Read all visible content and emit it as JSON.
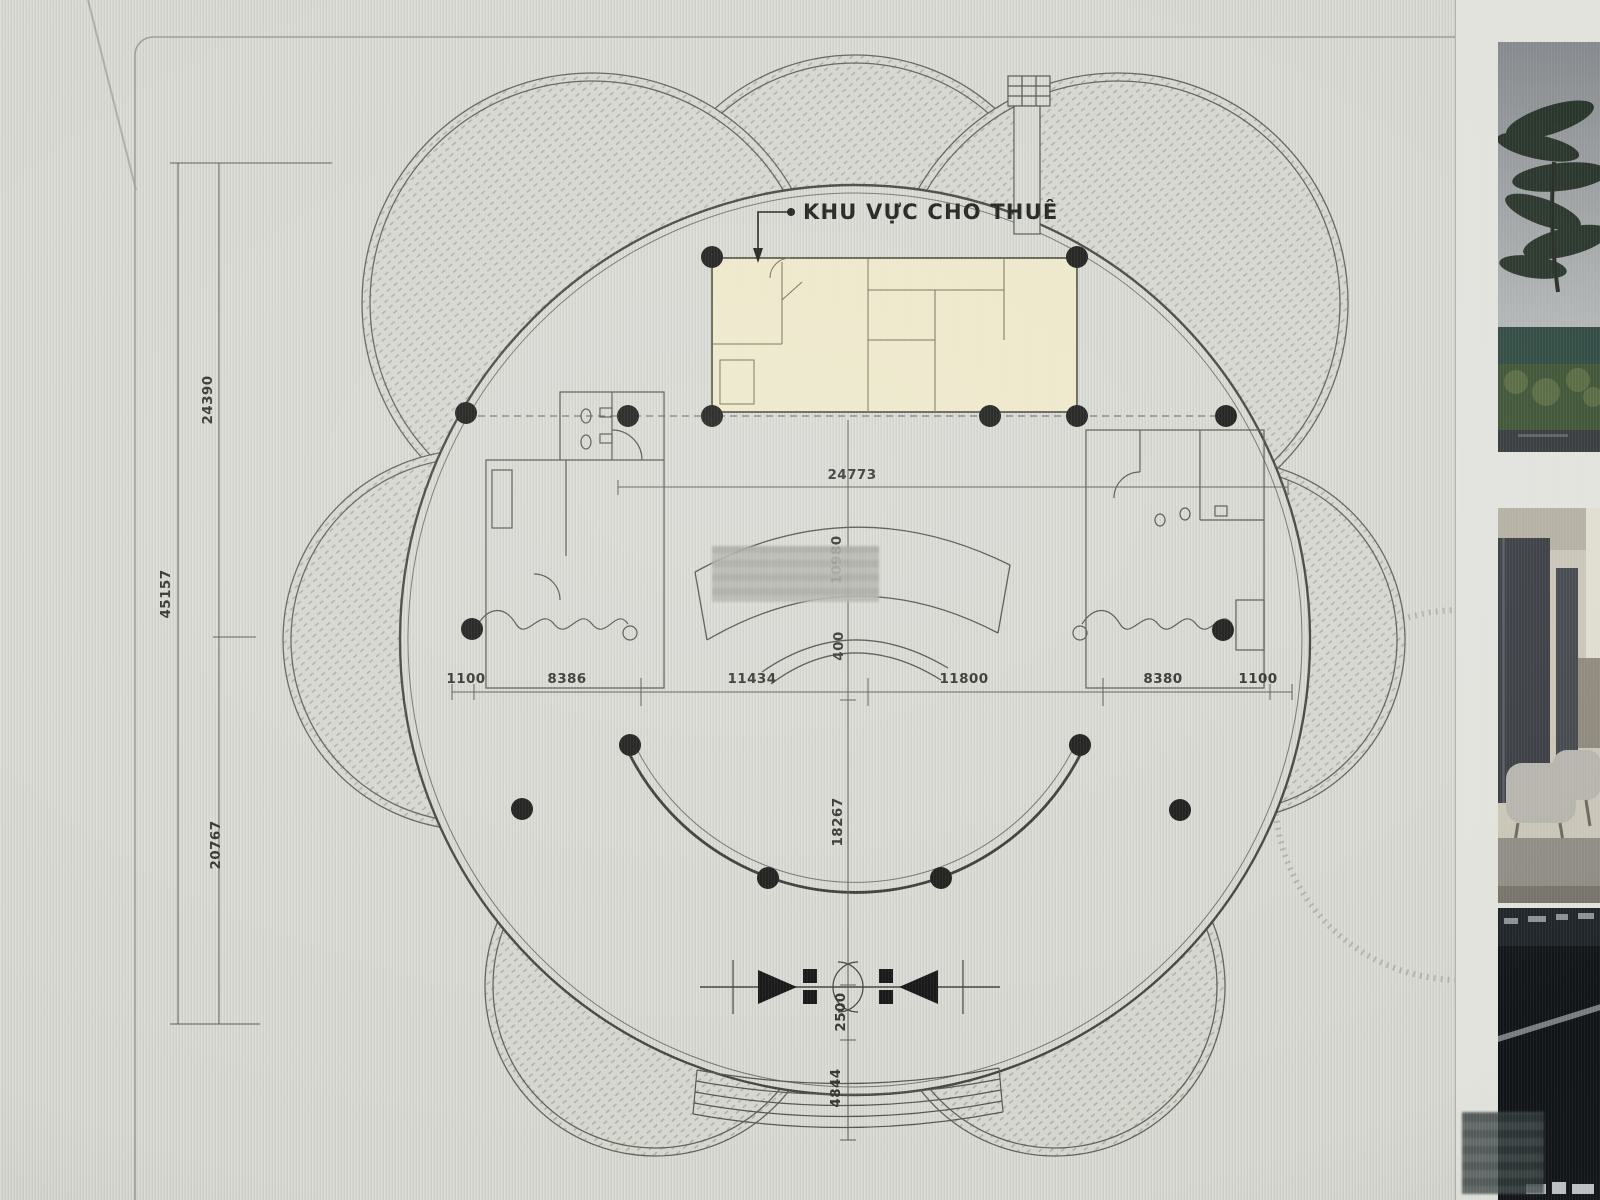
{
  "plan": {
    "leased_area_label": "KHU VỰC CHO THUÊ",
    "dims": {
      "total_height": "45157",
      "upper_height": "24390",
      "lower_height": "20767",
      "hall_width": "24773",
      "stage_depth": "10980",
      "stage_gap": "400",
      "hall_depth": "18267",
      "entrance_depth": "2500",
      "steps_depth": "4844",
      "bay_left_end": "1100",
      "bay_left": "8386",
      "bay_center_left": "11434",
      "bay_center_right": "11800",
      "bay_right": "8380",
      "bay_right_end": "1100"
    }
  },
  "gallery": {
    "photos": [
      "palm-trees-exterior",
      "lobby-interior",
      "building-dark-night"
    ]
  },
  "colors": {
    "leased_fill": "#ECE7C8",
    "plan_line": "#4C4F48",
    "column_dot": "#171715",
    "sheet_bg": "#D5D6D0"
  }
}
